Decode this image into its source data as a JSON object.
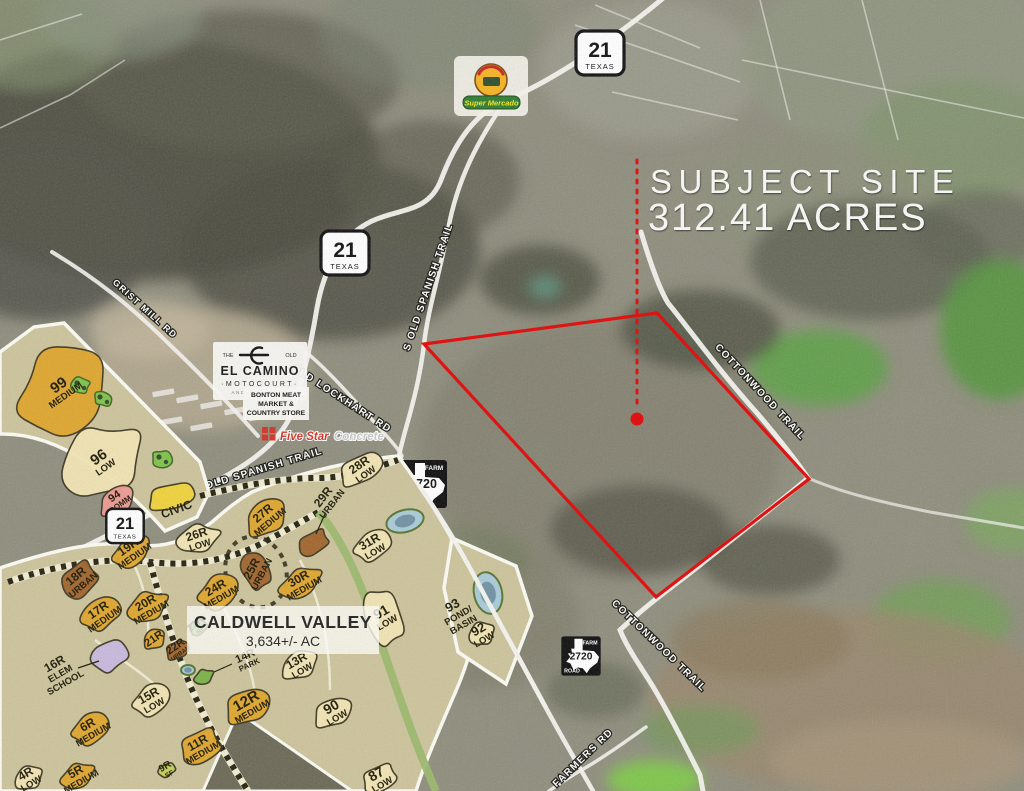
{
  "subject": {
    "title": "SUBJECT SITE",
    "acreage": "312.41 ACRES"
  },
  "site_boundary": {
    "color": "#de1414",
    "points": [
      [
        424,
        344
      ],
      [
        657,
        313
      ],
      [
        809,
        479
      ],
      [
        656,
        597
      ]
    ],
    "leader": {
      "x": 637,
      "y1": 160,
      "y2": 406
    },
    "marker": {
      "x": 637,
      "y": 419
    }
  },
  "shields": {
    "tx21": {
      "number": "21",
      "state": "TEXAS",
      "instances": [
        {
          "x": 600,
          "y": 53,
          "s": 1.0,
          "layer": "aerial"
        },
        {
          "x": 345,
          "y": 253,
          "s": 1.0,
          "layer": "aerial"
        },
        {
          "x": 125,
          "y": 526,
          "s": 0.78,
          "layer": "plan"
        }
      ]
    },
    "fm2720": {
      "top": "FARM",
      "number": "2720",
      "bottom": "ROAD",
      "instances": [
        {
          "x": 423,
          "y": 484,
          "s": 1.0,
          "layer": "aerial"
        },
        {
          "x": 581,
          "y": 656,
          "s": 0.82,
          "layer": "aerial"
        }
      ]
    }
  },
  "road_labels": [
    {
      "name": "s-old-spanish-trail-upper",
      "text": "S OLD SPANISH TRAIL",
      "x": 431,
      "y": 288,
      "rot": -71,
      "fs": 10
    },
    {
      "name": "s-old-spanish-trail-lower",
      "text": "S OLD SPANISH TRAIL",
      "x": 259,
      "y": 473,
      "rot": -17,
      "fs": 10
    },
    {
      "name": "old-lockhart-rd",
      "text": "OLD LOCKHART RD",
      "x": 340,
      "y": 401,
      "rot": 33,
      "fs": 10
    },
    {
      "name": "grist-mill-rd",
      "text": "GRIST MILL RD",
      "x": 143,
      "y": 311,
      "rot": 42,
      "fs": 9
    },
    {
      "name": "cottonwood-trail-upper",
      "text": "COTTONWOOD TRAIL",
      "x": 758,
      "y": 394,
      "rot": 47,
      "fs": 10
    },
    {
      "name": "cottonwood-trail-lower",
      "text": "COTTONWOOD TRAIL",
      "x": 657,
      "y": 648,
      "rot": 44,
      "fs": 10
    },
    {
      "name": "farmers-rd",
      "text": "FARMERS RD",
      "x": 585,
      "y": 760,
      "rot": -44,
      "fs": 10
    }
  ],
  "logos": {
    "mercado": {
      "banner": "Super Mercado"
    },
    "elcamino": {
      "the": "THE",
      "old": "OLD",
      "name": "EL CAMINO",
      "sub": "·MOTOCOURT·",
      "tagline": "AND RV RESORT"
    },
    "bonton": {
      "line1": "BONTON MEAT",
      "line2": "MARKET &",
      "line3": "COUNTRY STORE"
    },
    "fivestar": {
      "word1": "Five Star",
      "word2": "Concrete"
    }
  },
  "community": {
    "name": "CALDWELL VALLEY",
    "acreage": "3,634+/- AC"
  },
  "master_plan": {
    "colors": {
      "LOW": "#f3e6b4",
      "MEDIUM": "#e0a62a",
      "URBAN": "#a06229",
      "COMM": "#ef9a94",
      "CIVIC": "#f2d438",
      "NP": "#79b344",
      "SF": "#c3cf56",
      "PARK": "#79b344",
      "SCHOOL": "#c8b9e0",
      "POND": "#a9cbd8"
    },
    "parcels": [
      {
        "id": "99",
        "zone": "MEDIUM",
        "x": 62,
        "y": 390,
        "rx": 60,
        "ry": 50,
        "rot": -40,
        "lrot": -35,
        "idSize": 15
      },
      {
        "id": "96",
        "zone": "LOW",
        "x": 102,
        "y": 462,
        "rx": 52,
        "ry": 42,
        "rot": -40,
        "lrot": -35,
        "idSize": 15
      },
      {
        "id": "94",
        "zone": "COMM",
        "x": 117,
        "y": 500,
        "rx": 25,
        "ry": 15,
        "rot": -35,
        "lrot": -35,
        "idSize": 11,
        "zoneSize": 8
      },
      {
        "id": "",
        "zone": "CIVIC",
        "x": 172,
        "y": 497,
        "rx": 30,
        "ry": 16,
        "rot": -20,
        "lrot": -20,
        "zoneSize": 12
      },
      {
        "id": "18R",
        "zone": "URBAN",
        "x": 79,
        "y": 580,
        "rx": 25,
        "ry": 19,
        "rot": -40,
        "lrot": -40
      },
      {
        "id": "17R",
        "zone": "MEDIUM",
        "x": 101,
        "y": 614,
        "rx": 25,
        "ry": 19,
        "rot": -35,
        "lrot": -35
      },
      {
        "id": "19R",
        "zone": "MEDIUM",
        "x": 131,
        "y": 551,
        "rx": 26,
        "ry": 17,
        "rot": -35,
        "lrot": -35
      },
      {
        "id": "26R",
        "zone": "LOW",
        "x": 198,
        "y": 539,
        "rx": 26,
        "ry": 17,
        "rot": -18,
        "lrot": -18
      },
      {
        "id": "27R",
        "zone": "MEDIUM",
        "x": 266,
        "y": 517,
        "rx": 29,
        "ry": 19,
        "rot": -40,
        "lrot": -40
      },
      {
        "id": "28R",
        "zone": "LOW",
        "x": 362,
        "y": 469,
        "rx": 29,
        "ry": 17,
        "rot": -35,
        "lrot": -35
      },
      {
        "id": "29R",
        "zone": "URBAN",
        "x": 313,
        "y": 543,
        "rx": 21,
        "ry": 13,
        "rot": -30,
        "lrot": -52,
        "lx": 327,
        "ly": 500,
        "leader": [
          325,
          514,
          316,
          534
        ]
      },
      {
        "id": "25R",
        "zone": "URBAN",
        "x": 256,
        "y": 571,
        "rx": 16,
        "ry": 25,
        "rot": -20,
        "lrot": -62
      },
      {
        "id": "24R",
        "zone": "MEDIUM",
        "x": 218,
        "y": 592,
        "rx": 27,
        "ry": 19,
        "rot": -30,
        "lrot": -30
      },
      {
        "id": "20R",
        "zone": "MEDIUM",
        "x": 148,
        "y": 607,
        "rx": 25,
        "ry": 18,
        "rot": -30,
        "lrot": -30
      },
      {
        "id": "21R",
        "zone": "",
        "colorKey": "MEDIUM",
        "x": 154,
        "y": 639,
        "rx": 15,
        "ry": 11,
        "rot": -35,
        "lrot": -35,
        "idSize": 11
      },
      {
        "id": "22R",
        "zone": "URBAN",
        "x": 178,
        "y": 650,
        "rx": 15,
        "ry": 11,
        "rot": -35,
        "lrot": -35,
        "idSize": 11,
        "zoneSize": 6
      },
      {
        "id": "23R",
        "zone": "NP",
        "x": 198,
        "y": 627,
        "rx": 12,
        "ry": 9,
        "rot": -40,
        "lrot": -40,
        "idSize": 10,
        "zoneSize": 6
      },
      {
        "id": "16R",
        "zone": "ELEM SCHOOL",
        "colorKey": "SCHOOL",
        "x": 110,
        "y": 656,
        "rx": 23,
        "ry": 19,
        "rot": -30,
        "lrot": -30,
        "lx": 57,
        "ly": 668,
        "leader": [
          78,
          668,
          99,
          661
        ],
        "zoneTwoLine": true
      },
      {
        "id": "15R",
        "zone": "LOW",
        "x": 151,
        "y": 700,
        "rx": 25,
        "ry": 17,
        "rot": -30,
        "lrot": -30
      },
      {
        "id": "14R",
        "zone": "PARK",
        "x": 204,
        "y": 677,
        "rx": 12,
        "ry": 9,
        "rot": -30,
        "lrot": -25,
        "lx": 247,
        "ly": 660,
        "leader": [
          232,
          664,
          214,
          672
        ],
        "idSize": 11,
        "zoneSize": 8
      },
      {
        "id": "13R",
        "zone": "LOW",
        "x": 299,
        "y": 665,
        "rx": 25,
        "ry": 15,
        "rot": -30,
        "lrot": -30
      },
      {
        "id": "12R",
        "zone": "MEDIUM",
        "x": 249,
        "y": 706,
        "rx": 29,
        "ry": 21,
        "rot": -30,
        "lrot": -30,
        "idSize": 15
      },
      {
        "id": "11R",
        "zone": "MEDIUM",
        "x": 200,
        "y": 747,
        "rx": 27,
        "ry": 19,
        "rot": -30,
        "lrot": -30
      },
      {
        "id": "9R",
        "zone": "SF",
        "x": 167,
        "y": 770,
        "rx": 11,
        "ry": 8,
        "rot": -30,
        "lrot": -30,
        "idSize": 10,
        "zoneSize": 7
      },
      {
        "id": "6R",
        "zone": "MEDIUM",
        "x": 90,
        "y": 729,
        "rx": 25,
        "ry": 17,
        "rot": -30,
        "lrot": -30
      },
      {
        "id": "5R",
        "zone": "MEDIUM",
        "x": 78,
        "y": 776,
        "rx": 21,
        "ry": 15,
        "rot": -30,
        "lrot": -30
      },
      {
        "id": "4R",
        "zone": "LOW",
        "x": 28,
        "y": 778,
        "rx": 19,
        "ry": 13,
        "rot": -30,
        "lrot": -30
      },
      {
        "id": "90",
        "zone": "LOW",
        "x": 334,
        "y": 712,
        "rx": 25,
        "ry": 17,
        "rot": -30,
        "lrot": -30,
        "idSize": 14
      },
      {
        "id": "87",
        "zone": "LOW",
        "x": 379,
        "y": 779,
        "rx": 23,
        "ry": 15,
        "rot": -30,
        "lrot": -30,
        "idSize": 14
      },
      {
        "id": "91",
        "zone": "LOW",
        "x": 384,
        "y": 617,
        "rx": 22,
        "ry": 38,
        "rot": -18,
        "lrot": -30,
        "idSize": 14
      },
      {
        "id": "31R",
        "zone": "LOW",
        "x": 372,
        "y": 546,
        "rx": 25,
        "ry": 16,
        "rot": -30,
        "lrot": -30
      },
      {
        "id": "30R",
        "zone": "MEDIUM",
        "x": 301,
        "y": 583,
        "rx": 27,
        "ry": 17,
        "rot": -30,
        "lrot": -30
      },
      {
        "id": "92",
        "zone": "LOW",
        "x": 481,
        "y": 634,
        "rx": 17,
        "ry": 13,
        "rot": -30,
        "lrot": -30,
        "idSize": 13
      },
      {
        "id": "93",
        "zone": "POND/ BASIN",
        "x": 455,
        "y": 610,
        "rot": -30,
        "lrot": -30,
        "noBlob": true,
        "idSize": 13,
        "zoneTwoLine": true
      }
    ],
    "ponds": [
      {
        "x": 405,
        "y": 521,
        "rx": 19,
        "ry": 11,
        "rot": -15
      },
      {
        "x": 488,
        "y": 593,
        "rx": 14,
        "ry": 21,
        "rot": -12
      },
      {
        "x": 188,
        "y": 670,
        "rx": 7,
        "ry": 5,
        "rot": 0
      }
    ],
    "greens": [
      {
        "x": 80,
        "y": 385,
        "r": 12
      },
      {
        "x": 103,
        "y": 399,
        "r": 11
      },
      {
        "x": 162,
        "y": 459,
        "r": 13
      }
    ]
  }
}
